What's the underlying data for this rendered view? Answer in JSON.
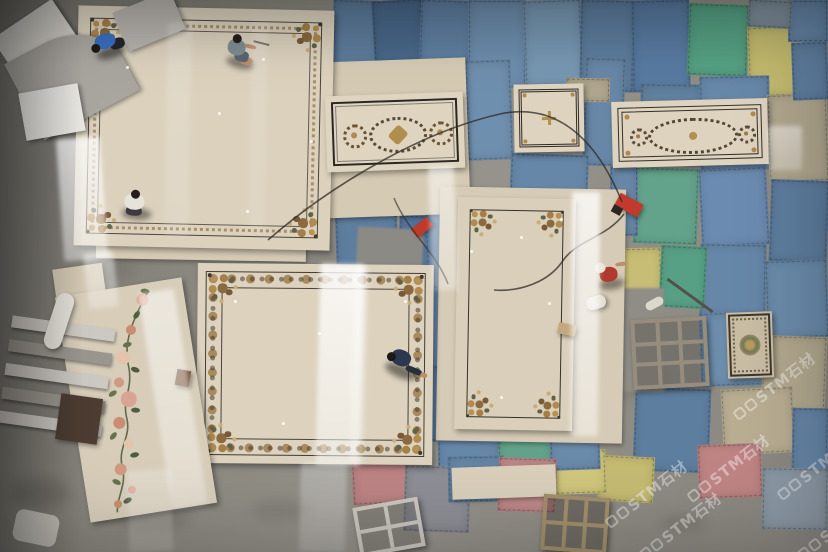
{
  "watermark": {
    "text": "STM石材",
    "color": "#ffffff",
    "opacity": 0.4,
    "instances": [
      [
        614,
        512
      ],
      [
        696,
        486
      ],
      [
        742,
        404
      ],
      [
        786,
        484
      ],
      [
        648,
        544
      ],
      [
        806,
        544
      ]
    ]
  },
  "scene": {
    "floor": {
      "base": "#8e8b84",
      "dark_left": "#74726c"
    },
    "mats": [
      [
        332,
        0,
        46,
        94,
        2,
        "#5d7c9c"
      ],
      [
        374,
        0,
        50,
        98,
        -3,
        "#49688a"
      ],
      [
        420,
        0,
        52,
        64,
        2,
        "#5f7fa0"
      ],
      [
        468,
        0,
        58,
        88,
        0,
        "#6d8dac"
      ],
      [
        524,
        0,
        58,
        86,
        -2,
        "#7797b2"
      ],
      [
        580,
        0,
        54,
        92,
        1,
        "#5d7d9e"
      ],
      [
        632,
        0,
        58,
        92,
        -1,
        "#587aa0"
      ],
      [
        688,
        4,
        60,
        72,
        2,
        "#55a083"
      ],
      [
        748,
        26,
        72,
        70,
        -2,
        "#c3ba6e"
      ],
      [
        788,
        0,
        40,
        42,
        0,
        "#6787a8"
      ],
      [
        748,
        0,
        44,
        28,
        3,
        "#7e8e9a"
      ],
      [
        584,
        58,
        40,
        108,
        2,
        "#6887a6"
      ],
      [
        466,
        60,
        46,
        100,
        -2,
        "#6f8fae"
      ],
      [
        640,
        84,
        62,
        82,
        1,
        "#60809f"
      ],
      [
        700,
        76,
        70,
        94,
        -1,
        "#6888a9"
      ],
      [
        768,
        94,
        60,
        88,
        -2,
        "#b1a78f"
      ],
      [
        770,
        180,
        58,
        82,
        2,
        "#5e7e9f"
      ],
      [
        700,
        168,
        68,
        78,
        -3,
        "#6b8bb0"
      ],
      [
        634,
        168,
        64,
        76,
        2,
        "#63a28b"
      ],
      [
        610,
        166,
        28,
        70,
        0,
        "#6887a6"
      ],
      [
        700,
        244,
        66,
        72,
        1,
        "#6787a8"
      ],
      [
        766,
        260,
        62,
        78,
        -2,
        "#6b8cab"
      ],
      [
        606,
        248,
        56,
        82,
        -1,
        "#c7bd75"
      ],
      [
        660,
        246,
        46,
        62,
        3,
        "#57a085"
      ],
      [
        700,
        312,
        64,
        74,
        -2,
        "#6d8dac"
      ],
      [
        762,
        336,
        64,
        76,
        2,
        "#b3a98f"
      ],
      [
        722,
        388,
        72,
        66,
        -3,
        "#b9ae92"
      ],
      [
        792,
        408,
        36,
        72,
        1,
        "#6787a8"
      ],
      [
        634,
        388,
        76,
        84,
        2,
        "#5e7e9f"
      ],
      [
        698,
        444,
        64,
        54,
        -2,
        "#bf8584"
      ],
      [
        762,
        468,
        66,
        62,
        1,
        "#8d9aa6"
      ],
      [
        598,
        456,
        56,
        46,
        3,
        "#c5bb73"
      ],
      [
        554,
        450,
        52,
        44,
        -2,
        "#d0c67c"
      ],
      [
        336,
        214,
        62,
        64,
        -2,
        "#5e7e9f"
      ],
      [
        398,
        216,
        58,
        72,
        3,
        "#54749a"
      ],
      [
        426,
        282,
        36,
        90,
        -2,
        "#6787a8"
      ],
      [
        428,
        366,
        36,
        76,
        2,
        "#5d7d9e"
      ],
      [
        438,
        436,
        62,
        50,
        -1,
        "#6787a8"
      ],
      [
        498,
        432,
        54,
        44,
        2,
        "#62a28b"
      ],
      [
        550,
        430,
        50,
        40,
        -2,
        "#6b8bab"
      ],
      [
        426,
        204,
        34,
        84,
        -2,
        "#5e7e9e"
      ],
      [
        510,
        154,
        78,
        62,
        2,
        "#6787a8"
      ],
      [
        352,
        450,
        64,
        54,
        -3,
        "#bd8484"
      ],
      [
        404,
        466,
        66,
        66,
        2,
        "#8e8e96"
      ],
      [
        448,
        456,
        56,
        46,
        -1,
        "#6787a8"
      ],
      [
        498,
        458,
        58,
        54,
        2,
        "#c08a8a"
      ],
      [
        792,
        42,
        36,
        58,
        -2,
        "#6080a2"
      ],
      [
        566,
        78,
        44,
        24,
        1,
        "#b1a78f"
      ]
    ],
    "concrete_patches": [
      [
        356,
        228,
        66,
        76,
        3,
        "#8c8a84"
      ],
      [
        598,
        288,
        66,
        104,
        0,
        "#908d86"
      ]
    ],
    "backings": [
      [
        318,
        60,
        150,
        156,
        -2,
        "#d5cab4"
      ],
      [
        438,
        188,
        186,
        254,
        1,
        "#d6cbb6"
      ],
      [
        56,
        266,
        50,
        58,
        -8,
        "#d2c7b2"
      ],
      [
        452,
        466,
        104,
        32,
        -2,
        "#d9cfbb"
      ],
      [
        96,
        236,
        210,
        24,
        1,
        "#d5cab5"
      ]
    ],
    "panels": [
      {
        "id": "panel-large-topleft",
        "x": 76,
        "y": 8,
        "w": 256,
        "h": 240,
        "rot": 1.2,
        "base": "#dbd1bd",
        "style": "double-frame-floral",
        "inset": 12,
        "corner": 34
      },
      {
        "id": "panel-horizontal-top",
        "x": 326,
        "y": 94,
        "w": 138,
        "h": 76,
        "rot": -2,
        "base": "#ded4c0",
        "style": "medallion-rosettes"
      },
      {
        "id": "panel-small-top",
        "x": 514,
        "y": 84,
        "w": 70,
        "h": 68,
        "rot": -1,
        "base": "#ddd3bf",
        "style": "small-cross"
      },
      {
        "id": "panel-long-top",
        "x": 612,
        "y": 100,
        "w": 156,
        "h": 66,
        "rot": -1.5,
        "base": "#ddd3bf",
        "style": "long-medallion"
      },
      {
        "id": "panel-vertical-center",
        "x": 456,
        "y": 198,
        "w": 118,
        "h": 232,
        "rot": 1,
        "base": "#d9cfbb",
        "style": "thin-frame-floral",
        "inset": 12,
        "corner": 30
      },
      {
        "id": "panel-large-bottom",
        "x": 197,
        "y": 264,
        "w": 236,
        "h": 200,
        "rot": 0.5,
        "base": "#dcd2be",
        "style": "ornate-band",
        "corner": 34
      },
      {
        "id": "panel-floral-strip",
        "x": 72,
        "y": 286,
        "w": 128,
        "h": 228,
        "rot": -9,
        "base": "#d7cdb9",
        "style": "vine"
      },
      {
        "id": "panel-rug-tile",
        "x": 727,
        "y": 312,
        "w": 46,
        "h": 66,
        "rot": -2,
        "base": "#c9bda4",
        "style": "rug"
      }
    ],
    "workers": [
      {
        "name": "worker-blue-shirt",
        "x": 88,
        "y": 26,
        "rot": -18,
        "parts": [
          [
            6,
            20,
            30,
            12,
            "rgba(18,15,12,.5)",
            50,
            3
          ],
          [
            22,
            14,
            15,
            11,
            "#23262e",
            40,
            0
          ],
          [
            8,
            6,
            21,
            15,
            "#3a6fc0",
            45,
            0
          ],
          [
            3,
            13,
            9,
            9,
            "#1f1a17",
            50,
            0
          ]
        ]
      },
      {
        "name": "worker-gray-shirt",
        "x": 220,
        "y": 36,
        "rot": 14,
        "parts": [
          [
            8,
            22,
            28,
            11,
            "rgba(18,15,12,.45)",
            50,
            3
          ],
          [
            21,
            20,
            13,
            8,
            "#b98f6e",
            40,
            0
          ],
          [
            15,
            15,
            14,
            11,
            "#5c6670",
            35,
            0
          ],
          [
            6,
            5,
            18,
            16,
            "#7e8d94",
            45,
            0
          ],
          [
            9,
            0,
            9,
            9,
            "#241f1b",
            50,
            0
          ],
          [
            22,
            7,
            12,
            4,
            "#b98f6e",
            40,
            0
          ],
          [
            30,
            2,
            16,
            2,
            "#6e6757",
            0,
            0
          ]
        ]
      },
      {
        "name": "worker-white-shirt",
        "x": 116,
        "y": 190,
        "rot": 4,
        "parts": [
          [
            6,
            18,
            30,
            12,
            "rgba(18,15,12,.45)",
            50,
            3
          ],
          [
            10,
            17,
            16,
            9,
            "#3a3a40",
            40,
            0
          ],
          [
            8,
            4,
            20,
            16,
            "#e6e3db",
            45,
            0
          ],
          [
            14,
            0,
            9,
            9,
            "#241f1b",
            50,
            0
          ]
        ]
      },
      {
        "name": "worker-navy-shirt",
        "x": 382,
        "y": 348,
        "rot": 22,
        "parts": [
          [
            4,
            18,
            34,
            13,
            "rgba(18,15,12,.5)",
            50,
            3
          ],
          [
            24,
            16,
            17,
            6,
            "#26303f",
            30,
            0
          ],
          [
            40,
            17,
            7,
            5,
            "#b98f6e",
            40,
            0
          ],
          [
            6,
            4,
            20,
            16,
            "#2c3750",
            45,
            0
          ],
          [
            2,
            10,
            9,
            9,
            "#1c1916",
            50,
            0
          ]
        ]
      },
      {
        "name": "worker-red-shirt",
        "x": 592,
        "y": 258,
        "rot": -8,
        "parts": [
          [
            6,
            20,
            26,
            11,
            "rgba(18,15,12,.45)",
            50,
            3
          ],
          [
            8,
            8,
            18,
            15,
            "#b03a2e",
            45,
            0
          ],
          [
            4,
            3,
            11,
            10,
            "#e8e4d8",
            50,
            0
          ],
          [
            25,
            5,
            12,
            4,
            "#b98f6e",
            40,
            0
          ]
        ]
      }
    ],
    "objects": [
      {
        "type": "rect",
        "name": "marble-slab",
        "x": 2,
        "y": 14,
        "w": 72,
        "h": 58,
        "rot": -34,
        "c": "#d6d3cc",
        "sh": 1
      },
      {
        "type": "rect",
        "name": "curved-slab-template",
        "x": 18,
        "y": 34,
        "w": 108,
        "h": 86,
        "rot": -28,
        "c": "#a9a6a0",
        "r": "0 60% 0 0",
        "sh": 1
      },
      {
        "type": "rect",
        "name": "gray-slab",
        "x": 118,
        "y": 0,
        "w": 62,
        "h": 42,
        "rot": -22,
        "c": "#b7b4ae",
        "sh": 1
      },
      {
        "type": "rect",
        "name": "white-tile",
        "x": 22,
        "y": 88,
        "w": 60,
        "h": 48,
        "rot": -10,
        "c": "#e9e7e2",
        "sh": 1
      },
      {
        "type": "rack",
        "name": "slab-rack",
        "x": 4,
        "y": 322,
        "w": 104,
        "h": 118,
        "rot": 8
      },
      {
        "type": "rect",
        "name": "pvc-pipe",
        "x": 50,
        "y": 292,
        "w": 18,
        "h": 58,
        "rot": 18,
        "c": "#e4e2da",
        "r": "9px",
        "sh": 1
      },
      {
        "type": "rect",
        "name": "dark-slab",
        "x": 58,
        "y": 396,
        "w": 42,
        "h": 46,
        "rot": 8,
        "c": "#4c3c32",
        "sh": 1
      },
      {
        "type": "grid",
        "name": "metal-grid-rack",
        "x": 632,
        "y": 318,
        "w": 76,
        "h": 70,
        "rot": -3,
        "c": "#968d7e",
        "bar": 4,
        "rows": 3,
        "cols": 3,
        "bg": "rgba(40,38,34,.25)"
      },
      {
        "type": "grid",
        "name": "wood-crate",
        "x": 542,
        "y": 496,
        "w": 66,
        "h": 56,
        "rot": 4,
        "c": "#a3906c",
        "bar": 4,
        "rows": 2,
        "cols": 3,
        "bg": "rgba(35,30,24,.3)"
      },
      {
        "type": "grid",
        "name": "light-rack",
        "x": 356,
        "y": 502,
        "w": 66,
        "h": 50,
        "rot": -10,
        "c": "#cbc7bf",
        "bar": 4,
        "rows": 2,
        "cols": 2,
        "bg": "rgba(60,58,52,.2)"
      },
      {
        "type": "rect",
        "name": "angle-grinder",
        "x": 616,
        "y": 198,
        "w": 26,
        "h": 14,
        "rot": 28,
        "c": "#c23a2c",
        "sh": 1
      },
      {
        "type": "rect",
        "name": "grinder-disc",
        "x": 612,
        "y": 206,
        "w": 10,
        "h": 8,
        "rot": 28,
        "c": "#2a2723"
      },
      {
        "type": "rect",
        "name": "red-tool",
        "x": 412,
        "y": 222,
        "w": 20,
        "h": 11,
        "rot": -38,
        "c": "#c0392b",
        "sh": 1
      },
      {
        "type": "rect",
        "name": "glove",
        "x": 645,
        "y": 299,
        "w": 19,
        "h": 9,
        "rot": -28,
        "c": "#ddd8cc",
        "r": "5px"
      },
      {
        "type": "rect",
        "name": "stick",
        "x": 662,
        "y": 294,
        "w": 56,
        "h": 3,
        "rot": 36,
        "c": "#55504a"
      },
      {
        "type": "rect",
        "name": "tan-pouch",
        "x": 558,
        "y": 324,
        "w": 18,
        "h": 11,
        "rot": 12,
        "c": "#c4a87e",
        "sh": 1
      },
      {
        "type": "rect",
        "name": "white-sack",
        "x": 586,
        "y": 296,
        "w": 20,
        "h": 13,
        "rot": -15,
        "c": "#e3e0d6",
        "r": "6px",
        "sh": 1
      },
      {
        "type": "rect",
        "name": "cloth",
        "x": 14,
        "y": 512,
        "w": 44,
        "h": 32,
        "rot": 12,
        "c": "#c6c3bb",
        "r": "8px"
      },
      {
        "type": "rect",
        "name": "brown-chip",
        "x": 176,
        "y": 370,
        "w": 14,
        "h": 16,
        "rot": 10,
        "c": "#7c5a40",
        "sh": 1
      }
    ],
    "reflections": [
      [
        318,
        264,
        44,
        202,
        1.5,
        0.85
      ],
      [
        352,
        266,
        14,
        198,
        1.5,
        0.4
      ],
      [
        300,
        462,
        46,
        90,
        1.5,
        0.3
      ],
      [
        571,
        192,
        28,
        244,
        0.5,
        0.8
      ],
      [
        430,
        166,
        26,
        124,
        -2,
        0.55
      ],
      [
        155,
        290,
        36,
        218,
        -9,
        0.55
      ],
      [
        60,
        138,
        44,
        122,
        -4,
        0.8
      ],
      [
        86,
        252,
        30,
        56,
        -6,
        0.5
      ],
      [
        166,
        22,
        24,
        214,
        1,
        0.2
      ],
      [
        250,
        22,
        16,
        210,
        1,
        0.14
      ],
      [
        128,
        470,
        44,
        82,
        -2,
        0.25
      ],
      [
        768,
        126,
        34,
        44,
        0,
        0.5
      ]
    ],
    "specks": [
      [
        262,
        58
      ],
      [
        310,
        140
      ],
      [
        246,
        210
      ],
      [
        520,
        236
      ],
      [
        548,
        302
      ],
      [
        500,
        396
      ],
      [
        234,
        300
      ],
      [
        318,
        332
      ],
      [
        404,
        300
      ],
      [
        282,
        422
      ],
      [
        560,
        218
      ],
      [
        470,
        250
      ],
      [
        218,
        112
      ],
      [
        126,
        66
      ]
    ],
    "stains": [
      [
        120,
        505,
        70,
        26,
        0.12
      ],
      [
        250,
        500,
        60,
        20,
        0.1
      ],
      [
        660,
        515,
        46,
        16,
        0.12
      ],
      [
        86,
        262,
        50,
        16,
        0.1
      ],
      [
        10,
        478,
        60,
        30,
        0.15
      ],
      [
        300,
        250,
        40,
        12,
        0.08
      ],
      [
        604,
        356,
        60,
        44,
        0.1
      ]
    ]
  }
}
